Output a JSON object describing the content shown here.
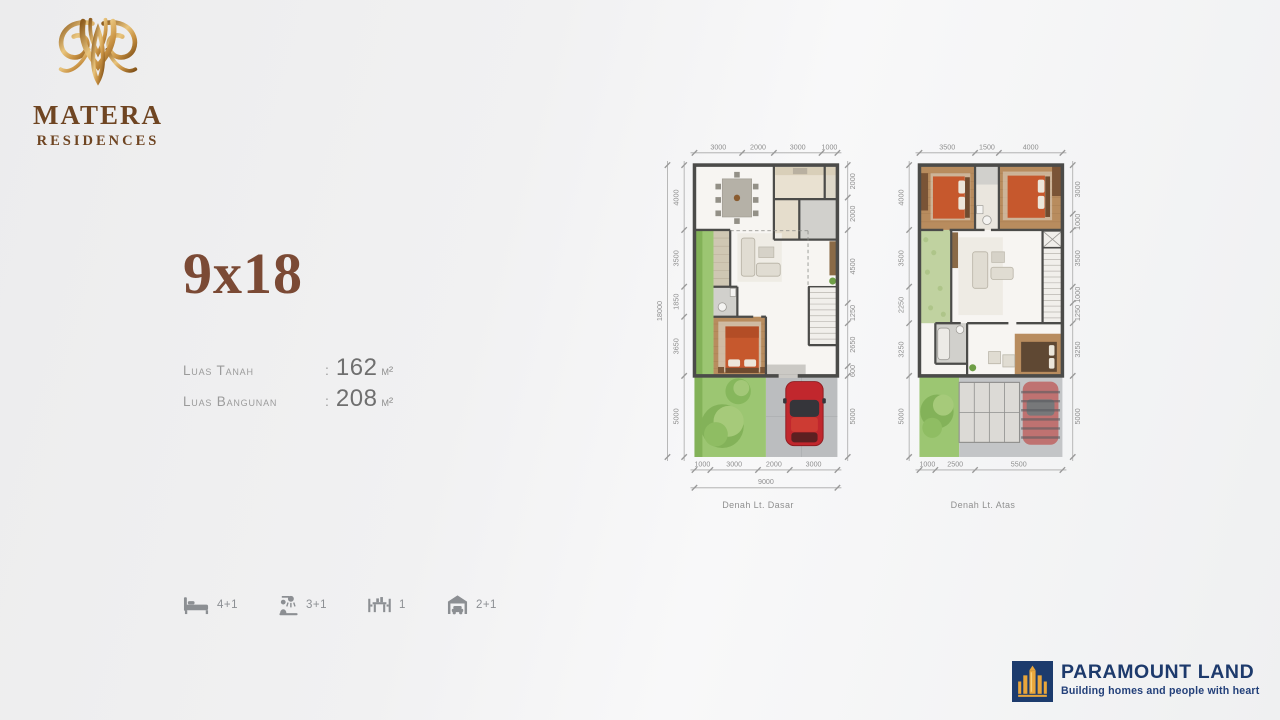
{
  "brand": {
    "name": "MATERA",
    "subtitle": "RESIDENCES"
  },
  "unit": {
    "type_label": "9x18",
    "separator": ":",
    "specs": [
      {
        "label": "Luas Tanah",
        "value": "162",
        "unit": "m²"
      },
      {
        "label": "Luas Bangunan",
        "value": "208",
        "unit": "m²"
      }
    ],
    "features": [
      {
        "icon": "bed-icon",
        "label": "4+1"
      },
      {
        "icon": "shower-icon",
        "label": "3+1"
      },
      {
        "icon": "dining-icon",
        "label": "1"
      },
      {
        "icon": "garage-icon",
        "label": "2+1"
      }
    ]
  },
  "plans": [
    {
      "caption": "Denah Lt. Dasar",
      "dims_top": [
        "3000",
        "2000",
        "3000",
        "1000"
      ],
      "dims_bottom": [
        "1000",
        "3000",
        "2000",
        "3000"
      ],
      "dims_bottom_total": "9000",
      "dims_left": [
        "4000",
        "3500",
        "1850",
        "3650",
        "5000"
      ],
      "dims_left_total": "18000",
      "dims_right": [
        "2000",
        "2000",
        "4500",
        "1250",
        "2650",
        "600",
        "5000"
      ]
    },
    {
      "caption": "Denah Lt. Atas",
      "dims_top": [
        "3500",
        "1500",
        "4000"
      ],
      "dims_bottom": [
        "1000",
        "2500",
        "5500"
      ],
      "dims_left": [
        "4000",
        "3500",
        "2250",
        "3250",
        "5000"
      ],
      "dims_right": [
        "3000",
        "1000",
        "3500",
        "1000",
        "1250",
        "3250",
        "5000"
      ]
    }
  ],
  "footer_brand": {
    "name": "PARAMOUNT LAND",
    "tagline": "Building homes and people with heart"
  },
  "colors": {
    "brand_brown": "#6f4522",
    "accent_brown": "#7b4a35",
    "gold": "#c89142",
    "navy": "#1d3a6c",
    "dim_text": "#8f8f8f",
    "garden_green": "#9cc672",
    "bed_red": "#c6582d",
    "car_red": "#c1272d"
  }
}
